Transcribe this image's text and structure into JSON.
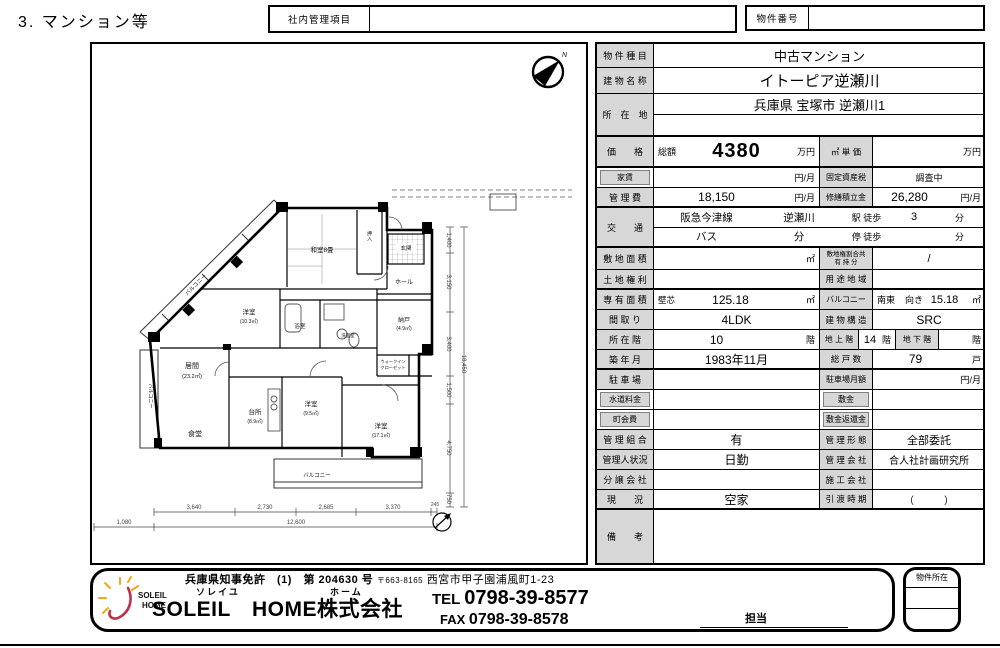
{
  "page": {
    "title": "3. マンション等"
  },
  "header": {
    "internal_label": "社内管理項目",
    "property_no_label": "物件番号"
  },
  "table": {
    "rows": [
      {
        "h": 24,
        "cells": [
          {
            "k": "lab",
            "t": "物 件 種 目",
            "w": 57
          },
          {
            "k": "val",
            "t": "中古マンション",
            "w": 331,
            "fs": 13
          }
        ]
      },
      {
        "h": 26,
        "cells": [
          {
            "k": "lab",
            "t": "建 物 名 称",
            "w": 57
          },
          {
            "k": "val",
            "t": "イトーピア逆瀬川",
            "w": 331,
            "fs": 15
          }
        ]
      },
      {
        "h": 43,
        "thick": true,
        "cells": [
          {
            "k": "lab",
            "t": "所　在　地",
            "w": 57
          },
          {
            "k": "val",
            "stack": [
              "兵庫県 宝塚市 逆瀬川1",
              ""
            ],
            "w": 331,
            "fs": 13
          }
        ]
      },
      {
        "h": 31,
        "thick": true,
        "cells": [
          {
            "k": "lab",
            "t": "価　　格",
            "w": 57
          },
          {
            "k": "sub",
            "t": "総額",
            "w": 40
          },
          {
            "k": "big",
            "t": "4380",
            "w": 85
          },
          {
            "k": "unit",
            "t": "万円",
            "w": 40
          },
          {
            "k": "labM",
            "t": "㎡ 単 価",
            "w": 54
          },
          {
            "k": "val",
            "t": "",
            "w": 73
          },
          {
            "k": "unit",
            "t": "万円",
            "w": 39
          }
        ]
      },
      {
        "h": 20,
        "cells": [
          {
            "k": "labIn",
            "t": "家賃",
            "w": 57
          },
          {
            "k": "val",
            "t": "",
            "w": 125
          },
          {
            "k": "unit",
            "t": "円/月",
            "w": 40
          },
          {
            "k": "labM",
            "t": "固定資産税",
            "w": 54,
            "fs": 8
          },
          {
            "k": "val",
            "t": "調査中",
            "w": 112,
            "fs": 9
          }
        ]
      },
      {
        "h": 20,
        "thick": true,
        "cells": [
          {
            "k": "lab",
            "t": "管 理 費",
            "w": 57
          },
          {
            "k": "val",
            "t": "18,150",
            "w": 125,
            "fs": 12
          },
          {
            "k": "unit",
            "t": "円/月",
            "w": 40
          },
          {
            "k": "labM",
            "t": "修繕積立金",
            "w": 54,
            "fs": 8
          },
          {
            "k": "val",
            "t": "26,280",
            "w": 73,
            "fs": 12
          },
          {
            "k": "unit",
            "t": "円/月",
            "w": 39
          }
        ]
      },
      {
        "h": 40,
        "thick": true,
        "cells": [
          {
            "k": "lab",
            "t": "交　　通",
            "w": 57
          },
          {
            "k": "val",
            "stack": [
              "阪急今津線",
              "バス"
            ],
            "w": 105,
            "fs": 10.5
          },
          {
            "k": "val",
            "stack": [
              "逆瀬川",
              "分"
            ],
            "w": 80,
            "fs": 10.5
          },
          {
            "k": "val",
            "stack": [
              "駅 徒歩",
              "停 徒歩"
            ],
            "w": 55,
            "fs": 9
          },
          {
            "k": "val",
            "stack": [
              "3",
              ""
            ],
            "w": 40,
            "fs": 11
          },
          {
            "k": "val",
            "stack": [
              "分",
              "分"
            ],
            "w": 51,
            "fs": 9
          }
        ]
      },
      {
        "h": 22,
        "cells": [
          {
            "k": "lab",
            "t": "敷 地 面 積",
            "w": 57
          },
          {
            "k": "val",
            "t": "",
            "w": 125
          },
          {
            "k": "unit",
            "t": "㎡",
            "w": 40
          },
          {
            "k": "labM",
            "lines": [
              "敷地権割合共",
              "有 持 分"
            ],
            "w": 54,
            "fs": 6.5
          },
          {
            "k": "val",
            "t": "/",
            "w": 112
          }
        ]
      },
      {
        "h": 20,
        "thick": true,
        "cells": [
          {
            "k": "lab",
            "t": "土 地 権 利",
            "w": 57
          },
          {
            "k": "val",
            "t": "",
            "w": 165
          },
          {
            "k": "labM",
            "t": "用 途 地 域",
            "w": 54
          },
          {
            "k": "val",
            "t": "",
            "w": 112
          }
        ]
      },
      {
        "h": 20,
        "cells": [
          {
            "k": "lab",
            "t": "専 有 面 積",
            "w": 57
          },
          {
            "k": "sub",
            "t": "壁芯",
            "w": 28,
            "fs": 8.5
          },
          {
            "k": "val",
            "t": "125.18",
            "w": 97,
            "fs": 12
          },
          {
            "k": "unit",
            "t": "㎡",
            "w": 40
          },
          {
            "k": "labM",
            "t": "バルコニー",
            "w": 54,
            "fs": 8
          },
          {
            "k": "sub",
            "t": "南東",
            "w": 28
          },
          {
            "k": "sub",
            "t": "向き",
            "w": 24
          },
          {
            "k": "val",
            "t": "15.18",
            "w": 39,
            "fs": 11
          },
          {
            "k": "unit",
            "t": "㎡",
            "w": 21
          }
        ]
      },
      {
        "h": 20,
        "cells": [
          {
            "k": "lab",
            "t": "間 取 り",
            "w": 57
          },
          {
            "k": "val",
            "t": "4LDK",
            "w": 165,
            "fs": 12
          },
          {
            "k": "labM",
            "t": "建 物 構 造",
            "w": 54
          },
          {
            "k": "val",
            "t": "SRC",
            "w": 112,
            "fs": 12
          }
        ]
      },
      {
        "h": 20,
        "cells": [
          {
            "k": "lab",
            "t": "所 在 階",
            "w": 57
          },
          {
            "k": "val",
            "t": "10",
            "w": 125,
            "fs": 12
          },
          {
            "k": "unit",
            "t": "階",
            "w": 40
          },
          {
            "k": "labM",
            "t": "地 上 階",
            "w": 40,
            "fs": 8
          },
          {
            "k": "val",
            "t": "14",
            "w": 22,
            "fs": 11
          },
          {
            "k": "unit",
            "t": "階",
            "w": 14
          },
          {
            "k": "labM",
            "t": "地 下 階",
            "w": 44,
            "fs": 8
          },
          {
            "k": "val",
            "t": "",
            "w": 22
          },
          {
            "k": "unit",
            "t": "階",
            "w": 24
          }
        ]
      },
      {
        "h": 20,
        "thick": true,
        "cells": [
          {
            "k": "lab",
            "t": "築 年 月",
            "w": 57
          },
          {
            "k": "val",
            "t": "1983年11月",
            "w": 165,
            "fs": 12
          },
          {
            "k": "labM",
            "t": "総 戸 数",
            "w": 54
          },
          {
            "k": "val",
            "t": "79",
            "w": 85,
            "fs": 12
          },
          {
            "k": "unit",
            "t": "戸",
            "w": 27
          }
        ]
      },
      {
        "h": 20,
        "cells": [
          {
            "k": "lab",
            "t": "駐 車 場",
            "w": 57
          },
          {
            "k": "val",
            "t": "",
            "w": 165
          },
          {
            "k": "labM",
            "t": "駐車場月額",
            "w": 54,
            "fs": 8
          },
          {
            "k": "val",
            "t": "",
            "w": 73
          },
          {
            "k": "unit",
            "t": "円/月",
            "w": 39
          }
        ]
      },
      {
        "h": 20,
        "cells": [
          {
            "k": "labIn",
            "t": "水道料金",
            "w": 57
          },
          {
            "k": "val",
            "t": "",
            "w": 165
          },
          {
            "k": "labInM",
            "t": "敷金",
            "w": 54
          },
          {
            "k": "val",
            "t": "",
            "w": 112
          }
        ]
      },
      {
        "h": 20,
        "cells": [
          {
            "k": "labIn",
            "t": "町会費",
            "w": 57
          },
          {
            "k": "val",
            "t": "",
            "w": 165
          },
          {
            "k": "labInM",
            "t": "敷金返還金",
            "w": 54
          },
          {
            "k": "val",
            "t": "",
            "w": 112
          }
        ]
      },
      {
        "h": 20,
        "cells": [
          {
            "k": "lab",
            "t": "管 理 組 合",
            "w": 57
          },
          {
            "k": "val",
            "t": "有",
            "w": 165,
            "fs": 12
          },
          {
            "k": "labM",
            "t": "管 理 形 態",
            "w": 54
          },
          {
            "k": "val",
            "t": "全部委託",
            "w": 112,
            "fs": 11
          }
        ]
      },
      {
        "h": 20,
        "cells": [
          {
            "k": "lab",
            "t": "管理人状況",
            "w": 57
          },
          {
            "k": "val",
            "t": "日勤",
            "w": 165,
            "fs": 12
          },
          {
            "k": "labM",
            "t": "管 理 会 社",
            "w": 54
          },
          {
            "k": "val",
            "t": "合人社計画研究所",
            "w": 112,
            "fs": 10
          }
        ]
      },
      {
        "h": 20,
        "cells": [
          {
            "k": "lab",
            "t": "分 譲 会 社",
            "w": 57
          },
          {
            "k": "val",
            "t": "",
            "w": 165
          },
          {
            "k": "labM",
            "t": "施 工 会 社",
            "w": 54
          },
          {
            "k": "val",
            "t": "",
            "w": 112
          }
        ]
      },
      {
        "h": 20,
        "thick": true,
        "cells": [
          {
            "k": "lab",
            "t": "現　　況",
            "w": 57
          },
          {
            "k": "val",
            "t": "空家",
            "w": 165,
            "fs": 12
          },
          {
            "k": "labM",
            "t": "引 渡 時 期",
            "w": 54
          },
          {
            "k": "val",
            "t": "（　　　）",
            "w": 112,
            "fs": 10
          }
        ]
      },
      {
        "h": 53,
        "cells": [
          {
            "k": "lab",
            "t": "備　　考",
            "w": 57
          },
          {
            "k": "val",
            "t": "",
            "w": 331
          }
        ]
      }
    ]
  },
  "plan": {
    "north": "N",
    "rooms": [
      {
        "label": "和室8畳"
      },
      {
        "label": "押入"
      },
      {
        "label": "玄関"
      },
      {
        "label": "ホール"
      },
      {
        "label": "納戸",
        "area": "(4.9㎡)"
      },
      {
        "label": "ウォークイン",
        "label2": "クローゼット"
      },
      {
        "label": "浴室"
      },
      {
        "label": "洗面室"
      },
      {
        "label": "洋室",
        "area": "(10.3㎡)"
      },
      {
        "label": "バルコニー"
      },
      {
        "label": "居間",
        "area": "(23.2㎡)"
      },
      {
        "label": "食堂"
      },
      {
        "label": "台所",
        "area": "(8.9㎡)"
      },
      {
        "label": "洋室",
        "area": "(9.5㎡)"
      },
      {
        "label": "洋室",
        "area": "(17.1㎡)"
      },
      {
        "label": "バルコニー"
      },
      {
        "label": "バルコニー"
      }
    ],
    "dims_b1": [
      "3,640",
      "2,730",
      "2,685",
      "3,370",
      "245"
    ],
    "dims_b2": [
      "1,080",
      "12,600"
    ],
    "dims_r": [
      "1,400",
      "3,150",
      "3,400",
      "1,500",
      "4,750",
      "750"
    ],
    "dims_r_total": "18,450"
  },
  "footer": {
    "license": "兵庫県知事免許　(1)　第 204630 号",
    "postal": "〒663-8165",
    "address": "西宮市甲子園浦風町1-23",
    "furigana_soleil": "ソレイユ",
    "furigana_home": "ホーム",
    "company": "SOLEIL　HOME株式会社",
    "tel_label": "TEL",
    "tel": "0798-39-8577",
    "fax_label": "FAX",
    "fax": "0798-39-8578",
    "staff_label": "担当",
    "location_box_label": "物件所在",
    "logo_line1": "SOLEIL",
    "logo_line2": "HOME",
    "accent_sun": "#f0a818",
    "accent_swoosh": "#c03048"
  }
}
